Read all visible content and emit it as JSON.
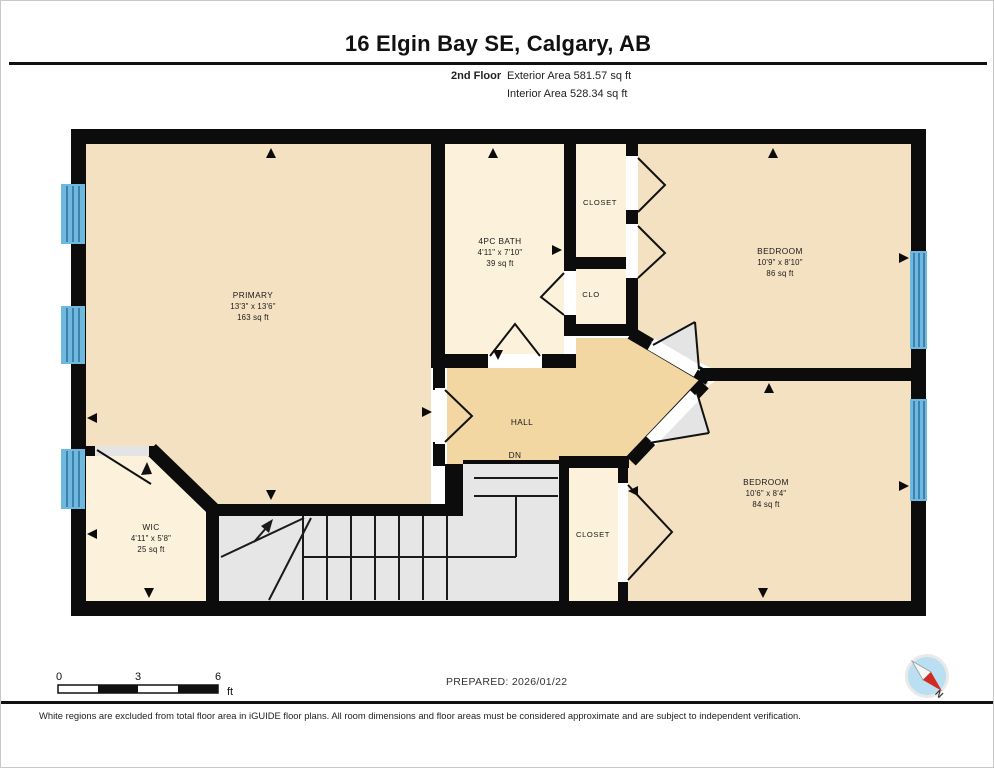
{
  "header": {
    "title": "16 Elgin Bay SE, Calgary, AB",
    "floor_label": "2nd Floor",
    "exterior_area": "Exterior Area 581.57 sq ft",
    "interior_area": "Interior Area 528.34 sq ft"
  },
  "rooms": {
    "primary": {
      "name": "PRIMARY",
      "dims": "13'3\" x 13'6\"",
      "area": "163 sq ft"
    },
    "bath": {
      "name": "4PC BATH",
      "dims": "4'11\" x 7'10\"",
      "area": "39 sq ft"
    },
    "closet_top": {
      "name": "CLOSET"
    },
    "clo": {
      "name": "CLO"
    },
    "bedroom_top": {
      "name": "BEDROOM",
      "dims": "10'9\" x 8'10\"",
      "area": "86 sq ft"
    },
    "bedroom_bottom": {
      "name": "BEDROOM",
      "dims": "10'6\" x 8'4\"",
      "area": "84 sq ft"
    },
    "hall": {
      "name": "HALL"
    },
    "stairs_label": {
      "name": "DN"
    },
    "closet_bottom": {
      "name": "CLOSET"
    },
    "wic": {
      "name": "WIC",
      "dims": "4'11\" x 5'8\"",
      "area": "25 sq ft"
    }
  },
  "scale_bar": {
    "start": "0",
    "mid": "3",
    "end": "6",
    "unit": "ft"
  },
  "footer": {
    "prepared": "PREPARED: 2026/01/22",
    "disclaimer": "White regions are excluded from total floor area in iGUIDE floor plans. All room dimensions and floor areas must be considered approximate and are subject to independent verification.",
    "compass_label": "N"
  },
  "colors": {
    "wall": "#0c0c0c",
    "room_tan": "#f3e1c1",
    "room_cream": "#fcf1da",
    "hall_tan": "#f2d7a2",
    "stairs_gray": "#e6e6e6",
    "window_blue": "#6fb8de",
    "window_stripe": "#2d6f9e",
    "compass_red": "#cf2b20",
    "compass_blue": "#badff2"
  }
}
